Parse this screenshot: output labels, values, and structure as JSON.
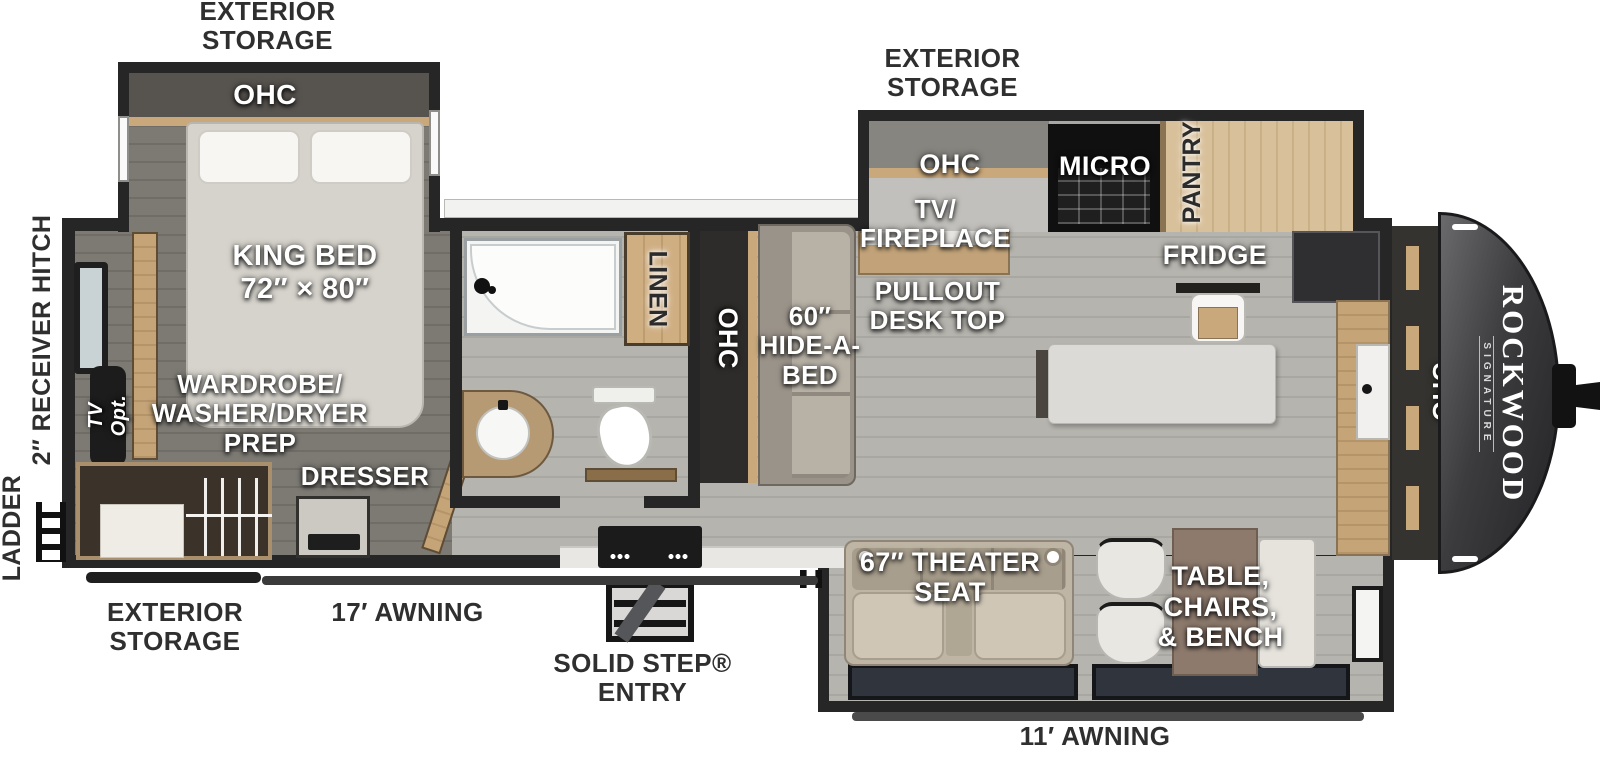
{
  "brand": {
    "name": "ROCKWOOD",
    "sub": "SIGNATURE"
  },
  "labels": {
    "exterior_storage": "EXTERIOR\nSTORAGE",
    "awning_17": "17′ AWNING",
    "awning_11": "11′ AWNING",
    "solid_step_entry": "SOLID STEP®\nENTRY",
    "ladder": "LADDER",
    "receiver_hitch": "2″ RECEIVER HITCH",
    "ohc": "OHC",
    "king_bed": "KING BED\n72″ × 80″",
    "wardrobe": "WARDROBE/\nWASHER/DRYER\nPREP",
    "tv_opt": "TV Opt.",
    "dresser": "DRESSER",
    "linen": "LINEN",
    "hide_a_bed": "60″\nHIDE-A-\nBED",
    "tv_fireplace": "TV/\nFIREPLACE",
    "pullout_desk": "PULLOUT\nDESK TOP",
    "micro": "MICRO",
    "pantry": "PANTRY",
    "fridge": "FRIDGE",
    "theater_seat": "67″ THEATER\nSEAT",
    "table_chairs_bench": "TABLE,\nCHAIRS,\n& BENCH"
  },
  "colors": {
    "wall": "#262626",
    "floor_light": "#b3b1ab",
    "floor_dark": "#7a7771",
    "wood": "#c9a87b",
    "exterior_label": "#2f2f2f",
    "interior_label": "#ffffff",
    "front_cap": "#3a3a3c"
  }
}
